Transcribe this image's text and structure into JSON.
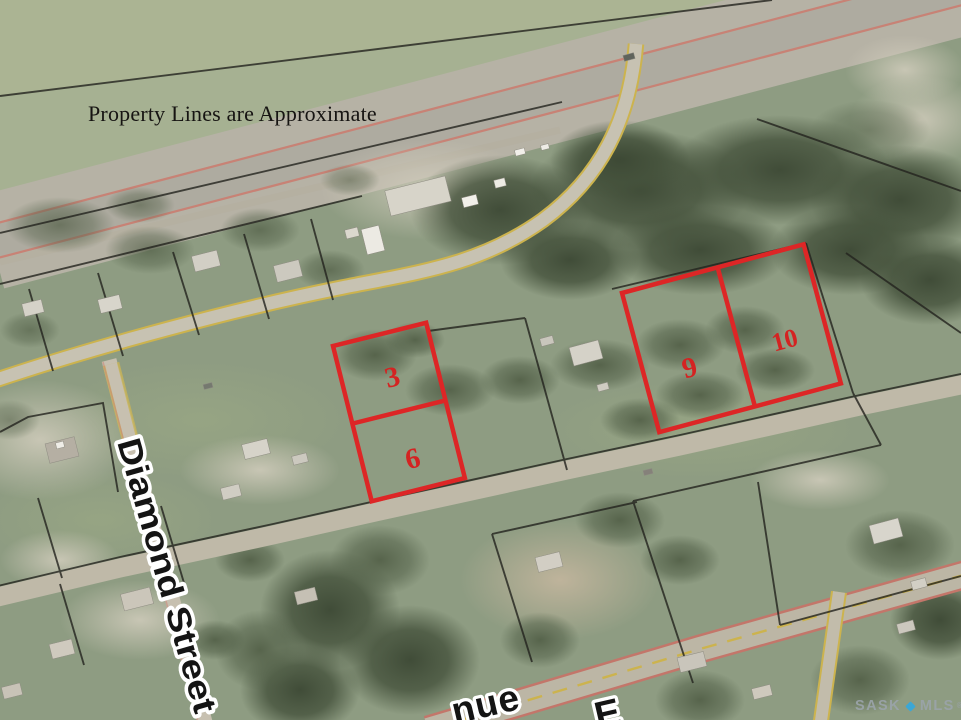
{
  "map": {
    "disclaimer": "Property Lines are Approximate",
    "street_label": "Diamond Street",
    "avenue_label_partial": "nue",
    "avenue_direction_partial": "E",
    "lots": [
      {
        "number": "3"
      },
      {
        "number": "6"
      },
      {
        "number": "9"
      },
      {
        "number": "10"
      }
    ],
    "watermark": {
      "brand_left": "SASK",
      "brand_right": "MLS",
      "registered": "®"
    },
    "colors": {
      "lot_outline": "#dd2626",
      "lot_number": "#d42322",
      "watermark_diamond": "#35a8dd",
      "watermark_text": "#9ba4aa",
      "street_line_yellow": "#ccb34e",
      "highway_line_pink": "#cd7a6d"
    }
  }
}
